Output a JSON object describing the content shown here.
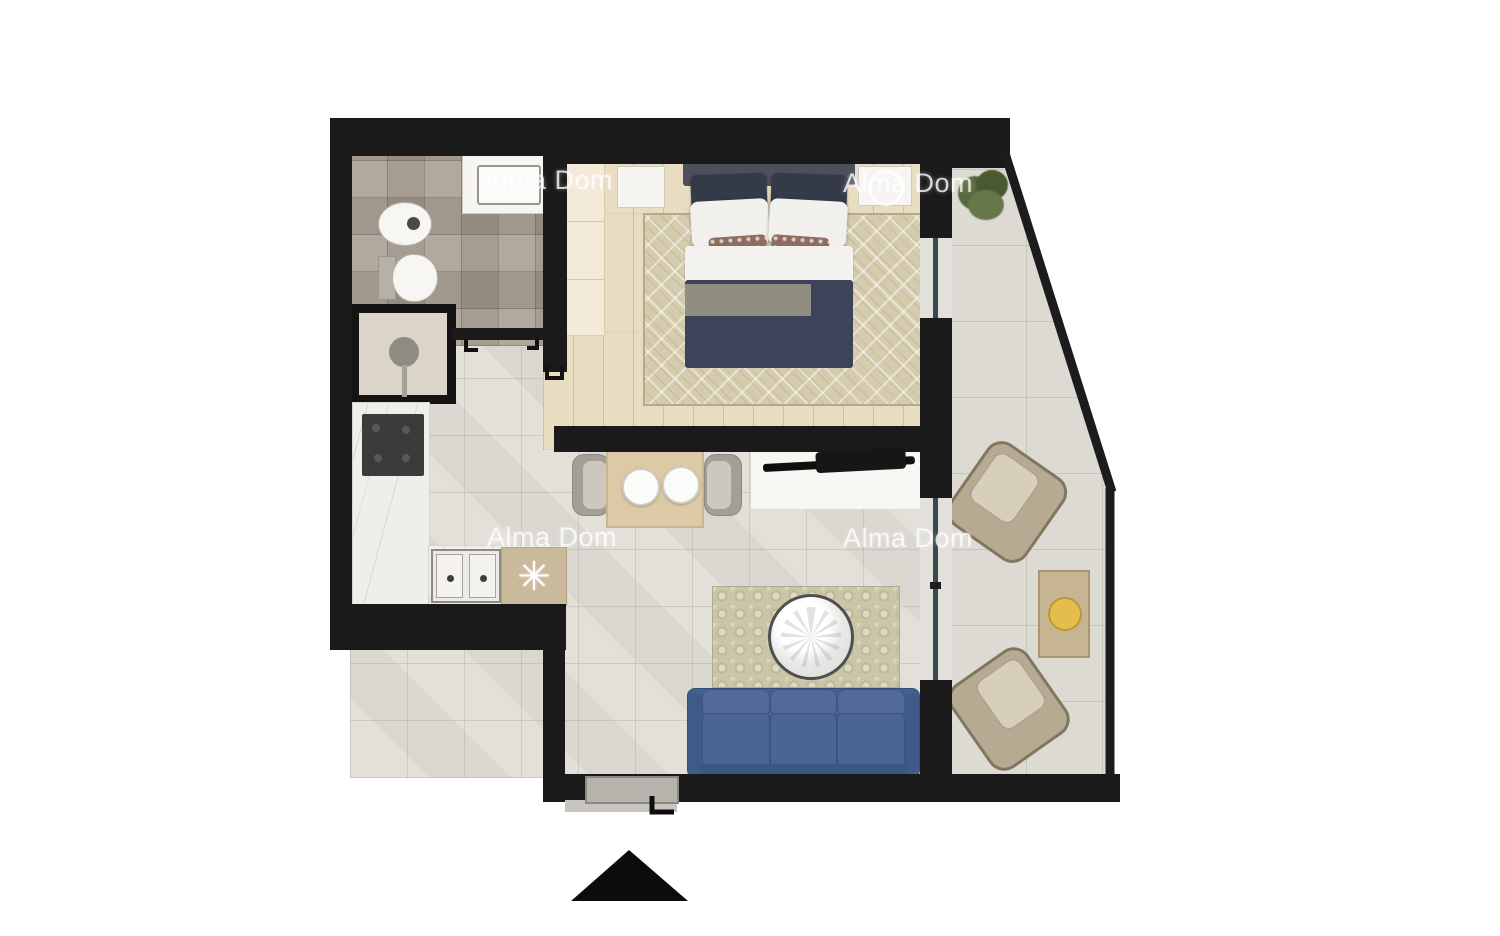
{
  "watermark": {
    "text": "Alma Dom"
  },
  "kitchen": {
    "boiler_symbol": "✳"
  },
  "colors": {
    "background": "#ffffff",
    "wall": "#1a1a1a",
    "bath_tile": "#a89f92",
    "wood": "#e8dcc1",
    "living_tile": "#e1ded7",
    "terrace_tile": "#dddad3",
    "bedroom_rug": "#d5ccae",
    "living_rug": "#cbc5a7",
    "sofa_blue": "#4a6494",
    "blanket_navy": "#3d4459",
    "duvet_white": "#f3f2ee",
    "accent_pillow": "#8e6c60",
    "marble": "#efeeeb",
    "stove_dark": "#3b3b3b",
    "cabinet_tan": "#cbb99b",
    "table_wood": "#dcc9a6",
    "console_white": "#f7f6f3",
    "chair_grey": "#a39f96",
    "armchair_beige": "#b7aa92",
    "gold": "#e3bd4d",
    "plant_green": "#57693c",
    "window_teal": "#39484b",
    "wardrobe_cream": "#f3ead8"
  }
}
